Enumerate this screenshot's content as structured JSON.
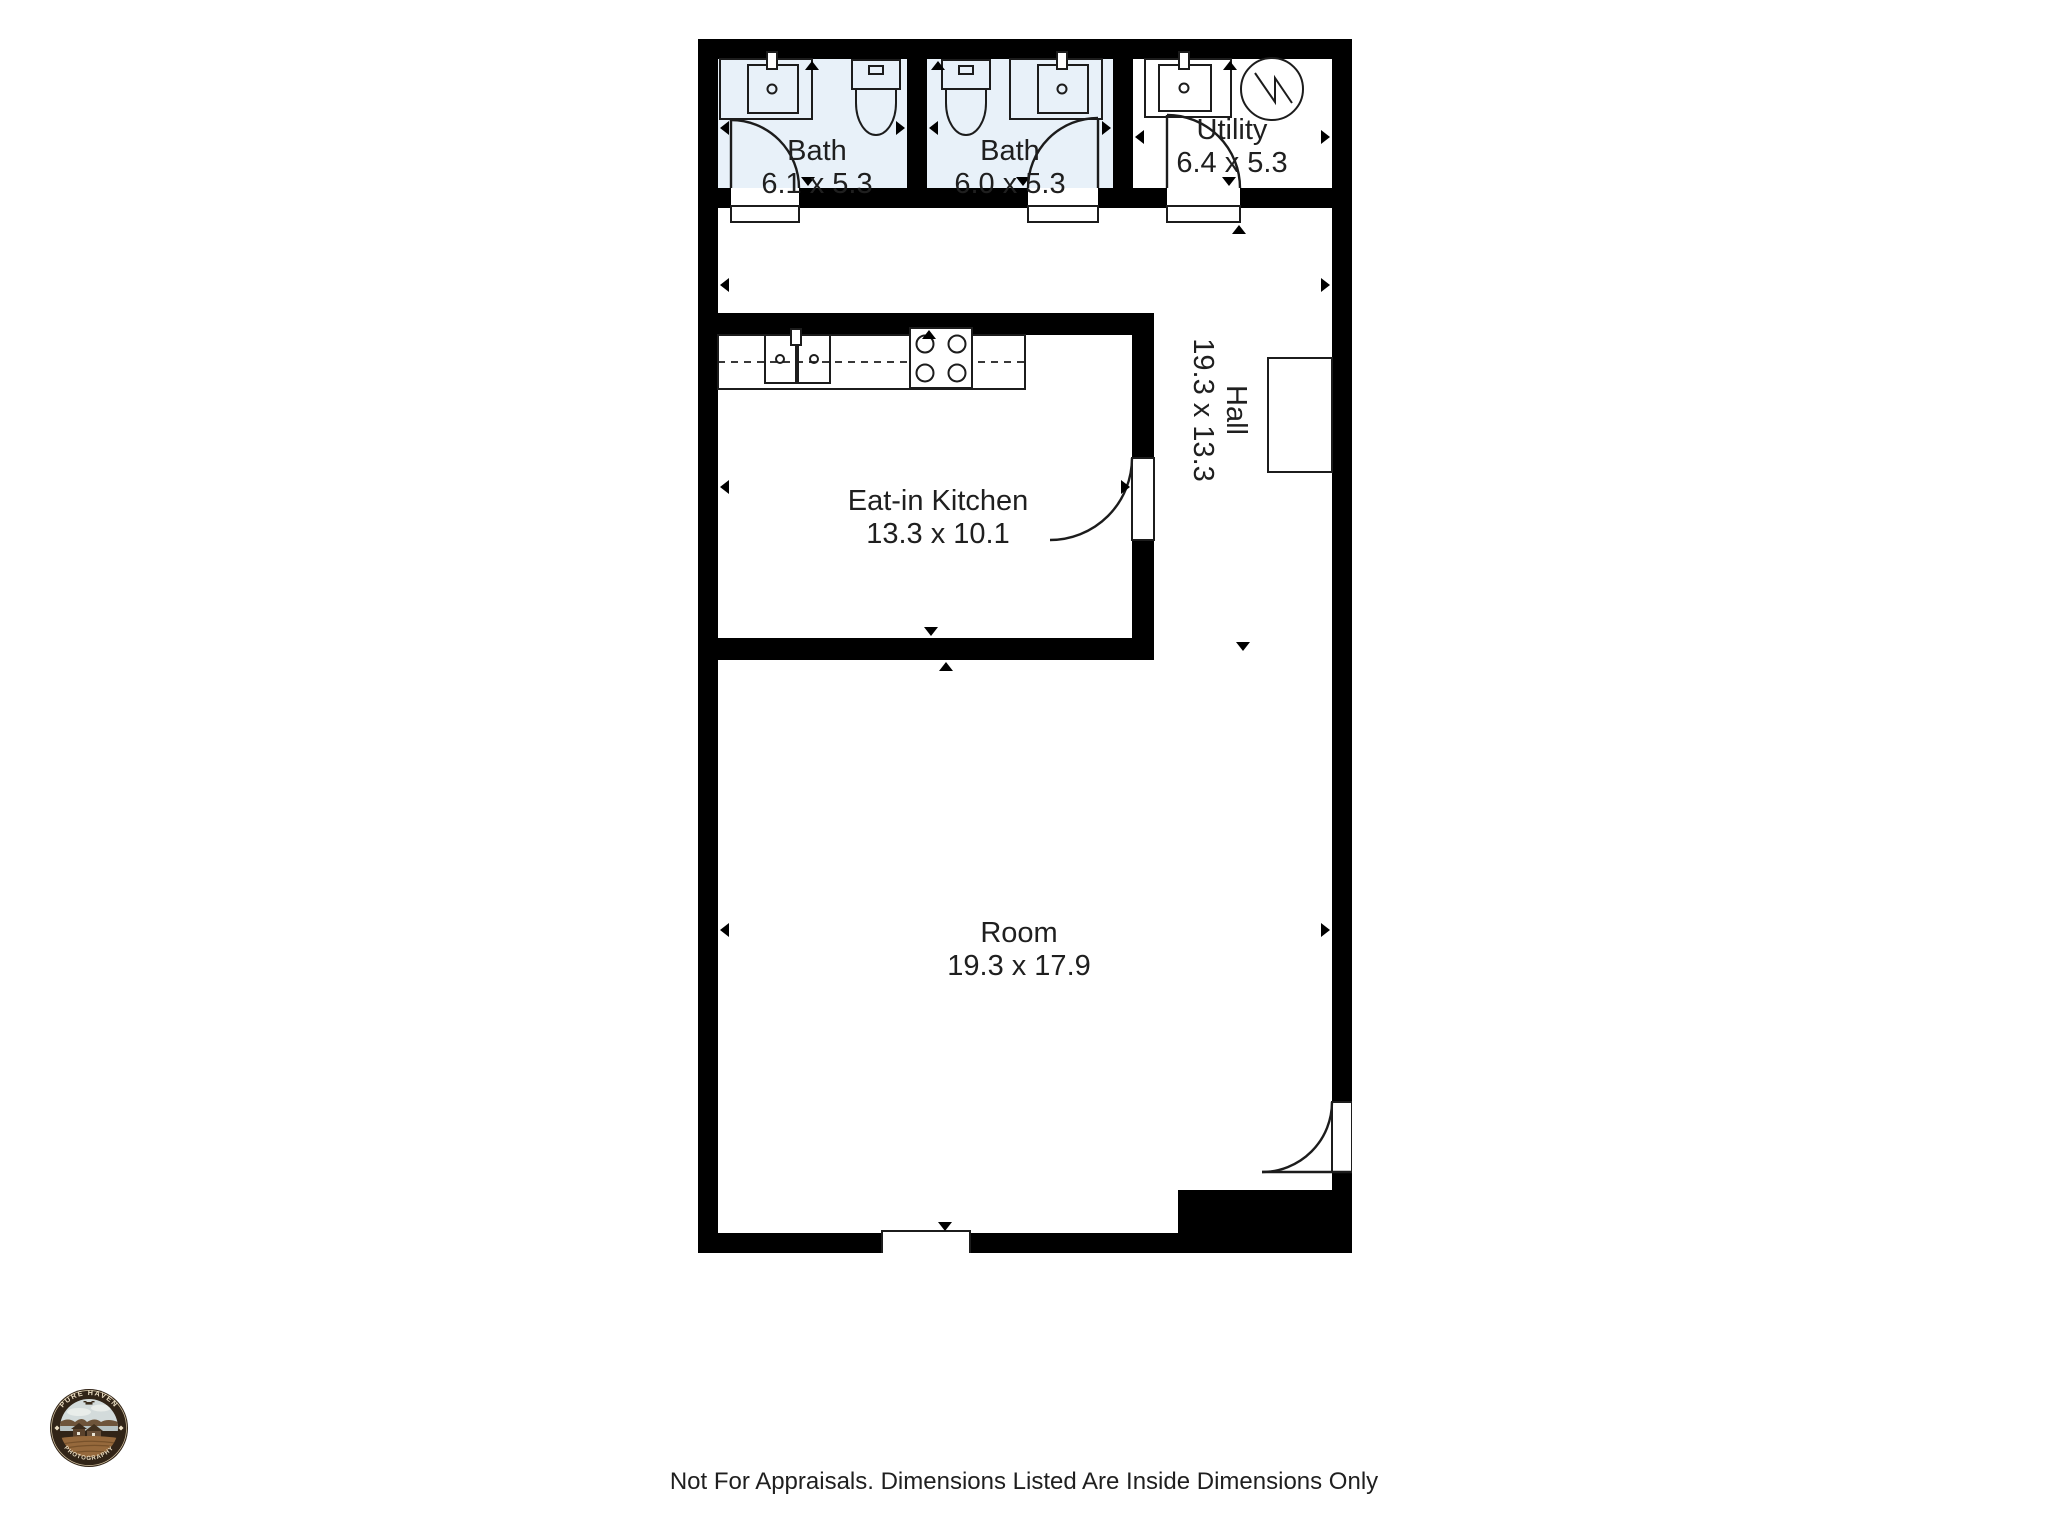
{
  "colors": {
    "wall": "#000000",
    "line": "#1c1c1c",
    "bath_fill": "#e8f1f9",
    "text": "#1f1f1f",
    "page_bg": "#ffffff"
  },
  "rooms": {
    "bath_1": {
      "label": "Bath",
      "dims": "6.1 x 5.3"
    },
    "bath_2": {
      "label": "Bath",
      "dims": "6.0 x 5.3"
    },
    "utility": {
      "label": "Utility",
      "dims": "6.4 x 5.3"
    },
    "hall": {
      "label": "Hall",
      "dims": "19.3 x 13.3"
    },
    "kitchen": {
      "label": "Eat-in Kitchen",
      "dims": "13.3 x 10.1"
    },
    "room": {
      "label": "Room",
      "dims": "19.3 x 17.9"
    }
  },
  "icons": {
    "sink": "basin with faucet and drain",
    "toilet": "tank and bowl",
    "water_heater": "circle with lightning zigzag",
    "stove": "four burner cooktop",
    "door": "quarter-circle swing arc",
    "dimension_arrow": "small solid triangle"
  },
  "logo": {
    "arc_top": "PURE HAVEN",
    "arc_bottom": "PHOTOGRAPHY"
  },
  "footer": {
    "disclaimer": "Not For Appraisals. Dimensions Listed Are Inside Dimensions Only"
  }
}
